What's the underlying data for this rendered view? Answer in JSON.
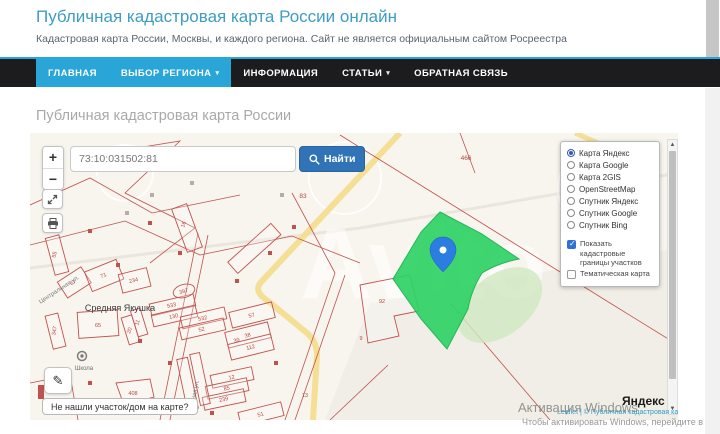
{
  "header": {
    "title": "Публичная кадастровая карта России онлайн",
    "subtitle": "Кадастровая карта России, Москвы, и каждого региона. Сайт не является официальным сайтом Росреестра"
  },
  "nav": {
    "items": [
      {
        "label": "ГЛАВНАЯ",
        "active": true,
        "caret": false
      },
      {
        "label": "ВЫБОР РЕГИОНА",
        "active": true,
        "caret": true
      },
      {
        "label": "ИНФОРМАЦИЯ",
        "active": false,
        "caret": false
      },
      {
        "label": "СТАТЬИ",
        "active": false,
        "caret": true
      },
      {
        "label": "ОБРАТНАЯ СВЯЗЬ",
        "active": false,
        "caret": false
      }
    ]
  },
  "page": {
    "title": "Публичная кадастровая карта России"
  },
  "map": {
    "search": {
      "value": "73:10:031502:81",
      "button": "Найти"
    },
    "controls": {
      "zoom_in": "+",
      "zoom_out": "−"
    },
    "layers": {
      "base": [
        {
          "label": "Карта Яндекс",
          "selected": true
        },
        {
          "label": "Карта Google",
          "selected": false
        },
        {
          "label": "Карта 2GIS",
          "selected": false
        },
        {
          "label": "OpenStreetMap",
          "selected": false
        },
        {
          "label": "Спутник Яндекс",
          "selected": false
        },
        {
          "label": "Спутник Google",
          "selected": false
        },
        {
          "label": "Спутник Bing",
          "selected": false
        }
      ],
      "overlays": [
        {
          "label": "Показать кадастровые границы участков",
          "checked": true
        },
        {
          "label": "Тематическая карта",
          "checked": false
        }
      ]
    },
    "labels": [
      {
        "t": "466",
        "x": 436,
        "y": 27,
        "cls": "big"
      },
      {
        "t": "83",
        "x": 273,
        "y": 65,
        "cls": "big"
      },
      {
        "t": "16",
        "x": 155,
        "y": 92,
        "r": -70,
        "cls": "num"
      },
      {
        "t": "55",
        "x": 26,
        "y": 122,
        "r": -75,
        "cls": "num"
      },
      {
        "t": "67",
        "x": 44,
        "y": 151,
        "r": -33,
        "cls": "num"
      },
      {
        "t": "71",
        "x": 74,
        "y": 144,
        "r": -22,
        "cls": "num"
      },
      {
        "t": "234",
        "x": 104,
        "y": 149,
        "r": -14,
        "cls": "num"
      },
      {
        "t": "397",
        "x": 154,
        "y": 160,
        "r": -15,
        "cls": "num"
      },
      {
        "t": "533",
        "x": 142,
        "y": 174,
        "r": -13,
        "cls": "num"
      },
      {
        "t": "130",
        "x": 144,
        "y": 185,
        "r": -13,
        "cls": "num"
      },
      {
        "t": "532",
        "x": 173,
        "y": 187,
        "r": -13,
        "cls": "num"
      },
      {
        "t": "52",
        "x": 172,
        "y": 198,
        "r": -13,
        "cls": "num"
      },
      {
        "t": "65",
        "x": 68,
        "y": 194,
        "cls": "num"
      },
      {
        "t": "347",
        "x": 26,
        "y": 198,
        "r": -80,
        "cls": "num"
      },
      {
        "t": "20",
        "x": 101,
        "y": 198,
        "r": -72,
        "cls": "num"
      },
      {
        "t": "11",
        "x": 109,
        "y": 190,
        "r": -72,
        "cls": "num"
      },
      {
        "t": "57",
        "x": 222,
        "y": 184,
        "r": -14,
        "cls": "num"
      },
      {
        "t": "38",
        "x": 218,
        "y": 204,
        "r": -14,
        "cls": "num"
      },
      {
        "t": "39",
        "x": 207,
        "y": 209,
        "r": -14,
        "cls": "num"
      },
      {
        "t": "112",
        "x": 221,
        "y": 216,
        "r": -14,
        "cls": "num"
      },
      {
        "t": "12",
        "x": 202,
        "y": 246,
        "r": -12,
        "cls": "num"
      },
      {
        "t": "85",
        "x": 197,
        "y": 257,
        "r": -12,
        "cls": "num"
      },
      {
        "t": "239",
        "x": 194,
        "y": 268,
        "r": -12,
        "cls": "num"
      },
      {
        "t": "51",
        "x": 231,
        "y": 283,
        "r": -14,
        "cls": "num"
      },
      {
        "t": "408",
        "x": 103,
        "y": 262,
        "cls": "num"
      },
      {
        "t": "92",
        "x": 352,
        "y": 170,
        "cls": "num"
      },
      {
        "t": "13",
        "x": 275,
        "y": 264,
        "cls": "num"
      },
      {
        "t": "9",
        "x": 331,
        "y": 207,
        "cls": "num"
      },
      {
        "t": "Средняя Якушка",
        "x": 90,
        "y": 178,
        "cls": "place"
      },
      {
        "t": "Центральная ул.",
        "x": 30,
        "y": 158,
        "r": -33,
        "cls": "street"
      },
      {
        "t": "Южная ул.",
        "x": 166,
        "y": 262,
        "r": -78,
        "cls": "street"
      },
      {
        "t": "Школа",
        "x": 54,
        "y": 237,
        "cls": "poi"
      }
    ],
    "not_found": "Не нашли участок/дом на карте?",
    "attribution": {
      "logo": "Яндекс",
      "line": "Leaflet | © Публичная кадастровая карта, ©"
    },
    "map_watermark": "Avito"
  },
  "watermark": {
    "line1": "Активация Windows",
    "line2": "Чтобы активировать Windows, перейдите в"
  },
  "colors": {
    "accent": "#29a5d8",
    "title": "#3d9dc2",
    "find_button": "#3173b7",
    "parcel_green": "#2fd366",
    "cadastral_red": "#c0524d",
    "pin_blue": "#2b7de0",
    "checkbox_blue": "#2f71d9"
  }
}
